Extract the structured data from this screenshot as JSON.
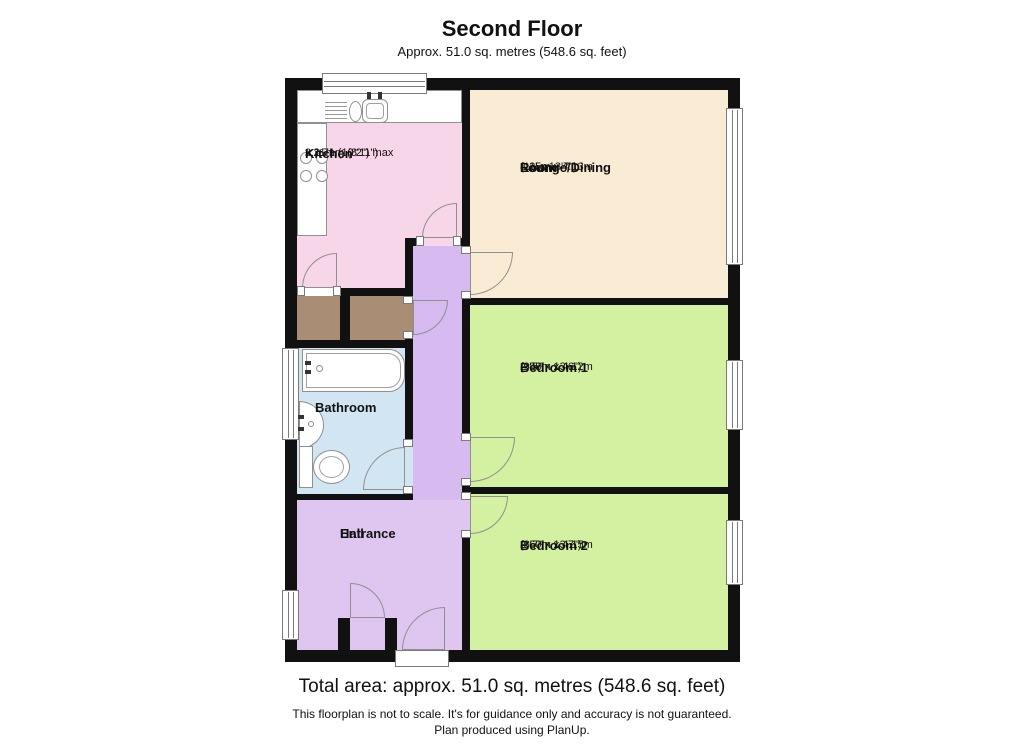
{
  "header": {
    "title": "Second Floor",
    "subtitle": "Approx. 51.0 sq. metres (548.6 sq. feet)"
  },
  "rooms": {
    "kitchen": {
      "name": "Kitchen",
      "dim1": "3.11m (10'2\") max",
      "dim2": "x 2.71m (8'11\")"
    },
    "lounge": {
      "name1": "Lounge/Dining",
      "name2": "Room",
      "dim1": "3.35m x 4.13m",
      "dim2": "(11' x 13'7\")"
    },
    "bedroom1": {
      "name": "Bedroom 1",
      "dim1": "2.88m x 4.12m",
      "dim2": "(9'5\" x 13'6\")"
    },
    "bedroom2": {
      "name": "Bedroom 2",
      "dim1": "2.60m x 4.15m",
      "dim2": "(8'7\" x 13'7\")"
    },
    "bathroom": {
      "name": "Bathroom"
    },
    "entrance_hall": {
      "name1": "Entrance",
      "name2": "Hall"
    }
  },
  "footer": {
    "total_area": "Total area: approx. 51.0 sq. metres (548.6 sq. feet)",
    "disclaimer": "This floorplan is not to scale. It's for guidance only and accuracy is not guaranteed.",
    "credit": "Plan produced using PlanUp."
  },
  "colors": {
    "wall": "#111111",
    "kitchen": "#f8d6e9",
    "lounge": "#faebd5",
    "bedroom": "#d4f0a1",
    "bathroom": "#d2e5f3",
    "hall": "#dec6f1",
    "corridor": "#d7baf0",
    "cupboard": "#a98e75",
    "window_frame": "#7a7a7a",
    "door_stroke": "#8f8f8f"
  }
}
